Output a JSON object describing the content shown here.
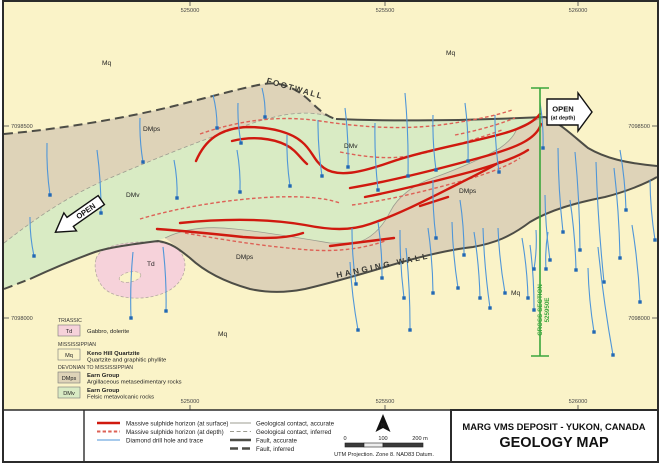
{
  "colors": {
    "c-mq": "#faf3c8",
    "c-td": "#f6d2da",
    "c-dmps": "#ded3b8",
    "c-dmv": "#d9ebc4",
    "c-fault": "#4d4d46",
    "c-contact": "#9c9c90",
    "c-red": "#d0190f",
    "c-reddash": "#dd6156",
    "c-drill": "#4f96d8",
    "c-drilldot": "#2268b4",
    "c-xsec": "#3aa63c"
  },
  "coords": {
    "top": [
      "525000",
      "525500",
      "526000"
    ],
    "bottom": [
      "525000",
      "525500",
      "526000"
    ],
    "left": [
      "7098500",
      "7098000"
    ],
    "right": [
      "7098500",
      "7098000"
    ]
  },
  "map": {
    "unit_labels": [
      {
        "text": "Mq"
      },
      {
        "text": "Mq"
      },
      {
        "text": "Mq"
      },
      {
        "text": "Mq"
      },
      {
        "text": "DMps"
      },
      {
        "text": "DMps"
      },
      {
        "text": "DMps"
      },
      {
        "text": "DMv"
      },
      {
        "text": "DMv"
      },
      {
        "text": "Td"
      }
    ],
    "footwall": "FOOTWALL",
    "hanging_wall": "HANGING WALL",
    "open_left": "OPEN",
    "open_right": "OPEN",
    "open_right_sub": "(at depth)",
    "cross_section_label": "CROSS-SECTION",
    "cross_section_easting": "525950E"
  },
  "unit_legend": {
    "triassic_header": "TRIASSIC",
    "td_code": "Td",
    "td_desc": "Gabbro, dolerite",
    "miss_header": "MISSISSIPPIAN",
    "mq_code": "Mq",
    "mq_name": "Keno Hill Quartzite",
    "mq_desc": "Quartzite and graphitic phyllite",
    "dev_header": "DEVONIAN TO MISSISSIPPIAN",
    "dmps_code": "DMps",
    "dmps_name": "Earn Group",
    "dmps_desc": "Argillaceous metasedimentary rocks",
    "dmv_code": "DMv",
    "dmv_name": "Earn Group",
    "dmv_desc": "Felsic metavolcanic rocks"
  },
  "symbol_legend": {
    "sulphide_surface": "Massive sulphide horizon (at surface)",
    "sulphide_depth": "Massive sulphide horizon (at depth)",
    "drill": "Diamond drill hole and trace",
    "contact_accurate": "Geological contact, accurate",
    "contact_inferred": "Geological contact, inferred",
    "fault_accurate": "Fault, accurate",
    "fault_inferred": "Fault, inferred"
  },
  "scalebar": {
    "t0": "0",
    "t100": "100",
    "t200": "200 m",
    "utm": "UTM Projection. Zone 8. NAD83 Datum.",
    "north": "N"
  },
  "title_block": {
    "line1": "MARG VMS DEPOSIT - YUKON, CANADA",
    "line2": "GEOLOGY MAP"
  },
  "drill_traces": [
    [
      47,
      143,
      50,
      195
    ],
    [
      97,
      150,
      101,
      213
    ],
    [
      30,
      217,
      34,
      256
    ],
    [
      174,
      160,
      177,
      198
    ],
    [
      140,
      118,
      143,
      162
    ],
    [
      213,
      95,
      217,
      128
    ],
    [
      238,
      103,
      241,
      143
    ],
    [
      262,
      88,
      265,
      117
    ],
    [
      287,
      135,
      290,
      186
    ],
    [
      237,
      150,
      240,
      192
    ],
    [
      318,
      120,
      322,
      176
    ],
    [
      345,
      108,
      348,
      167
    ],
    [
      375,
      123,
      378,
      190
    ],
    [
      405,
      93,
      408,
      176
    ],
    [
      433,
      115,
      436,
      170
    ],
    [
      465,
      103,
      468,
      161
    ],
    [
      495,
      115,
      499,
      172
    ],
    [
      540,
      102,
      543,
      148
    ],
    [
      352,
      228,
      356,
      284
    ],
    [
      378,
      222,
      382,
      278
    ],
    [
      400,
      230,
      404,
      298
    ],
    [
      428,
      228,
      433,
      293
    ],
    [
      452,
      222,
      458,
      288
    ],
    [
      474,
      232,
      480,
      298
    ],
    [
      498,
      228,
      505,
      293
    ],
    [
      522,
      238,
      528,
      298
    ],
    [
      433,
      180,
      436,
      238
    ],
    [
      460,
      200,
      464,
      255
    ],
    [
      545,
      195,
      550,
      260
    ],
    [
      570,
      200,
      576,
      270
    ],
    [
      558,
      148,
      563,
      232
    ],
    [
      575,
      152,
      580,
      250
    ],
    [
      596,
      162,
      604,
      282
    ],
    [
      614,
      168,
      620,
      258
    ],
    [
      598,
      247,
      613,
      355
    ],
    [
      632,
      225,
      640,
      302
    ],
    [
      650,
      180,
      655,
      240
    ],
    [
      620,
      150,
      626,
      210
    ],
    [
      350,
      262,
      358,
      330
    ],
    [
      406,
      248,
      410,
      330
    ],
    [
      483,
      228,
      490,
      308
    ],
    [
      530,
      245,
      534,
      310
    ],
    [
      133,
      252,
      131,
      318
    ],
    [
      163,
      247,
      166,
      311
    ],
    [
      588,
      268,
      594,
      332
    ],
    [
      536,
      230,
      534,
      269
    ],
    [
      548,
      232,
      546,
      269
    ]
  ]
}
